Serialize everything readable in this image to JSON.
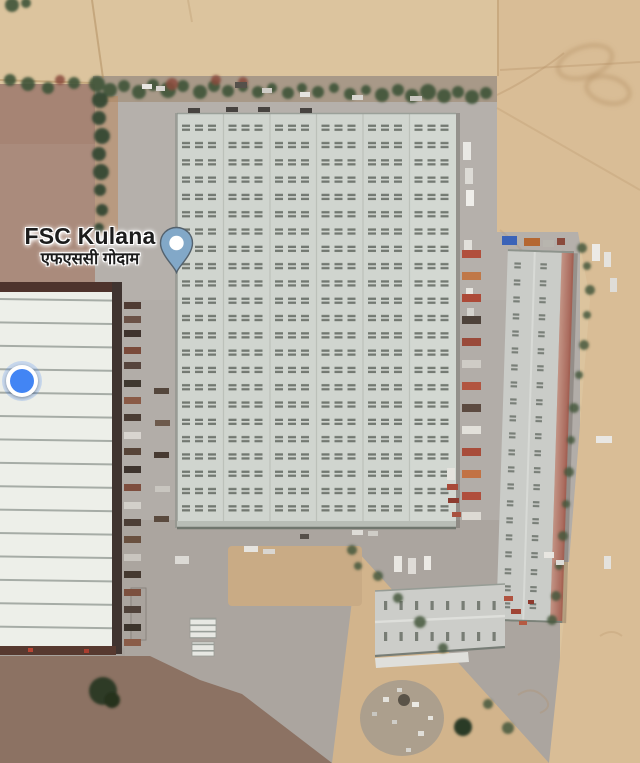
{
  "map": {
    "view": "satellite",
    "place_label": {
      "name": "FSC Kulana",
      "local_name": "एफएससी गोदाम"
    },
    "icons": {
      "pin": "place-pin-icon",
      "dot": "current-location-dot-icon"
    },
    "colors": {
      "pin_fill": "#82a8c8",
      "pin_stroke": "#54626e",
      "pin_center": "#ffffff",
      "location_dot": "#4285f4",
      "dot_ring": "#ffffff",
      "label_text": "#1c1c1c",
      "label_halo": "#ffffff"
    }
  }
}
